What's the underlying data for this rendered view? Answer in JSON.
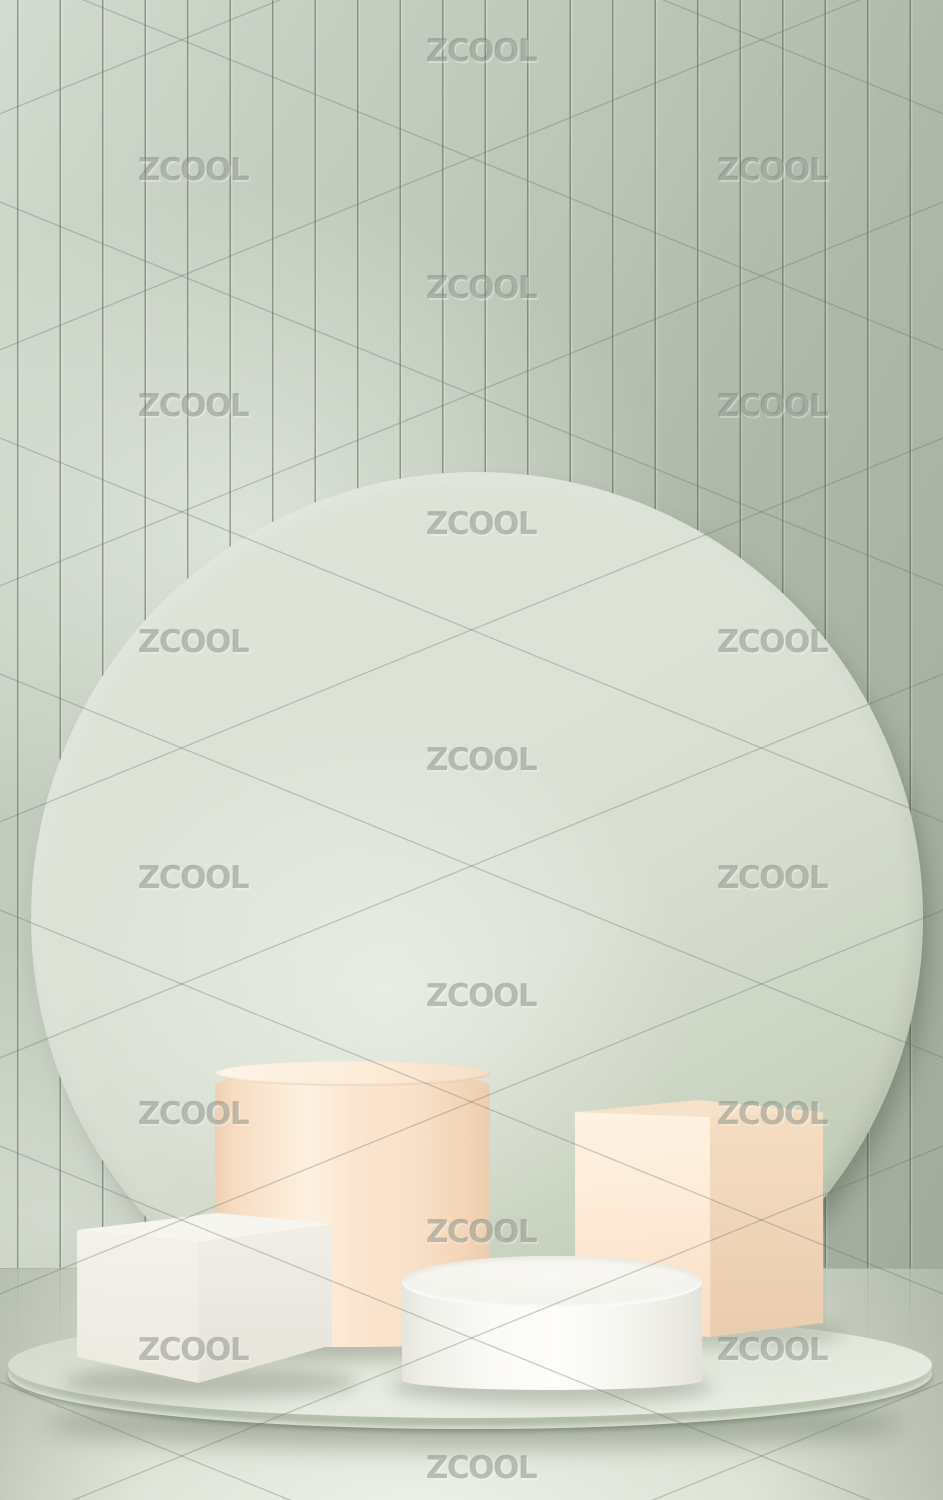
{
  "watermark": {
    "text": "ZCOOL",
    "positions": [
      {
        "x": 481,
        "y": 51
      },
      {
        "x": 193,
        "y": 170
      },
      {
        "x": 772,
        "y": 170
      },
      {
        "x": 481,
        "y": 288
      },
      {
        "x": 193,
        "y": 406
      },
      {
        "x": 772,
        "y": 406
      },
      {
        "x": 481,
        "y": 524
      },
      {
        "x": 193,
        "y": 642
      },
      {
        "x": 772,
        "y": 642
      },
      {
        "x": 481,
        "y": 760
      },
      {
        "x": 193,
        "y": 878
      },
      {
        "x": 772,
        "y": 878
      },
      {
        "x": 481,
        "y": 996
      },
      {
        "x": 193,
        "y": 1114
      },
      {
        "x": 772,
        "y": 1114
      },
      {
        "x": 481,
        "y": 1232
      },
      {
        "x": 193,
        "y": 1350
      },
      {
        "x": 772,
        "y": 1350
      },
      {
        "x": 481,
        "y": 1468
      }
    ]
  },
  "colors": {
    "wall_base": "#bec8b9",
    "wall_highlight": "#e8ece1",
    "wall_shadow": "#9aa794",
    "slat_line": "#55644f",
    "circle_light": "#dfe4d9",
    "circle_base": "#d7ded1",
    "circle_shadow": "#b7c2ab",
    "peach_highlight": "#fdf0e0",
    "peach_base": "#f9e1c9",
    "peach_shadow": "#eccdaf",
    "cream_highlight": "#f7f5ef",
    "cream_base": "#f1eee7",
    "cream_shadow": "#e6e3da",
    "white_highlight": "#fefdfb",
    "white_base": "#f4f3ed",
    "white_shadow": "#e2e1da",
    "platform_top": "#e0e5d9",
    "platform_side": "#c1cbba",
    "floor_base": "#ccd4c6",
    "floor_light": "#e7ebdf",
    "shadow_tint": "#4b5a42",
    "watermark_gray": "#6f786e"
  }
}
